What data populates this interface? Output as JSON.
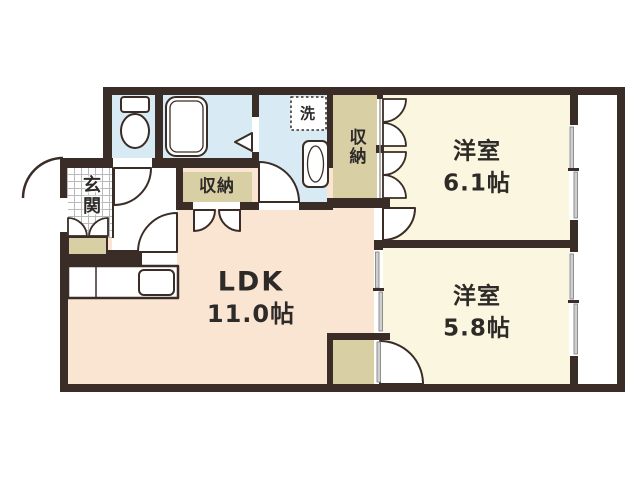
{
  "floorplan": {
    "title": "1LDK-type apartment floor plan",
    "rooms": {
      "ldk": {
        "label": "LDK",
        "area": "11.0帖"
      },
      "bedroom1": {
        "label": "洋室",
        "area": "6.1帖"
      },
      "bedroom2": {
        "label": "洋室",
        "area": "5.8帖"
      },
      "entrance": {
        "label": "玄関"
      },
      "closet_bedroom1": {
        "label": "収納"
      },
      "closet_hall": {
        "label": "収納"
      },
      "washer_space": {
        "label": "洗"
      }
    },
    "colors": {
      "wall": "#3a2c26",
      "bedroom_floor": "#faf6df",
      "ldk_floor": "#fae5d3",
      "wet_area": "#d8eaf3",
      "storage": "#d9cfa5",
      "label_text": "#2e2a28"
    }
  }
}
